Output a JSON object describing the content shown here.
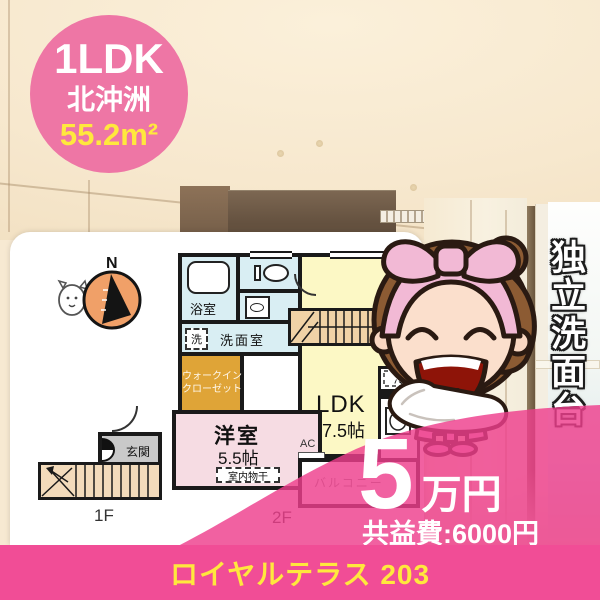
{
  "badge": {
    "layout": "1LDK",
    "area_name": "北沖洲",
    "size": "55.2m²"
  },
  "feature": {
    "vertical_text": "独立洗面台"
  },
  "price": {
    "amount": "5",
    "unit": "万円",
    "common_fee": "共益費:6000円"
  },
  "footer": {
    "property": "ロイヤルテラス 203"
  },
  "floorplan": {
    "compass": "N",
    "bath": "浴室",
    "washer": "洗",
    "washroom": "洗面室",
    "wic_line1": "ウォークイン",
    "wic_line2": "クローゼット",
    "ldk": "LDK",
    "ldk_size": "17.5帖",
    "bedroom": "洋室",
    "bedroom_size": "5.5帖",
    "indoor_drying": "室内物干",
    "ac": "AC",
    "fridge": "冷",
    "balcony": "バルコニー",
    "entrance": "玄関",
    "floor_1f": "1F",
    "floor_2f": "2F"
  },
  "colors": {
    "badge_pink": "#EE76A5",
    "overlay_pink": "#EE3E8C",
    "banner_pink": "#F14D96",
    "accent_yellow": "#FFE83D",
    "ldk_yellow": "#FCF8C5",
    "bath_blue": "#D9EEF3",
    "wic_orange": "#DFA437",
    "bedroom_pink": "#F6DCE3",
    "stairs_tan": "#F0D2A6"
  }
}
